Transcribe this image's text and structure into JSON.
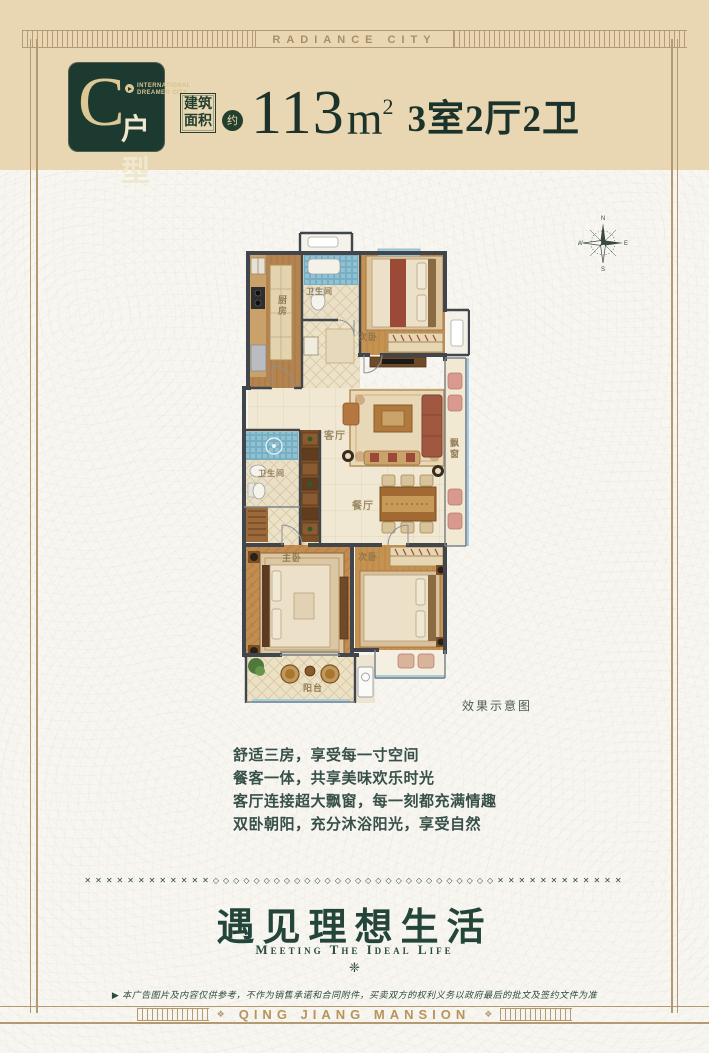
{
  "banner": {
    "top_text": "RADIANCE CITY",
    "bottom_text": "QING JIANG MANSION",
    "bottom_ornament": "❖"
  },
  "header": {
    "logo": {
      "letter": "C",
      "org_line1": "INTERNATIONAL",
      "org_line2": "DREAMER CITY",
      "type_label": "户型"
    },
    "area_box_line1": "建筑",
    "area_box_line2": "面积",
    "approx": "约",
    "area_value": "113",
    "area_unit": "m",
    "area_exponent": "2",
    "layout_spec": "3室2厅2卫"
  },
  "floorplan": {
    "caption": "效果示意图",
    "compass": {
      "n": "N",
      "e": "E",
      "s": "S",
      "w": "W"
    },
    "rooms": [
      {
        "label": "厨房"
      },
      {
        "label": "卫生间"
      },
      {
        "label": "次卧"
      },
      {
        "label": "客厅"
      },
      {
        "label": "餐厅"
      },
      {
        "label": "飘窗"
      },
      {
        "label": "卫生间"
      },
      {
        "label": "主卧"
      },
      {
        "label": "次卧"
      },
      {
        "label": "阳台"
      }
    ]
  },
  "features": {
    "lines": [
      "舒适三房，享受每一寸空间",
      "餐客一体，共享美味欢乐时光",
      "客厅连接超大飘窗，每一刻都充满情趣",
      "双卧朝阳，充分沐浴阳光，享受自然"
    ]
  },
  "slogan": {
    "divider": "✕✕✕✕✕✕✕✕✕✕✕✕◇◇◇◇◇◇◇◇◇◇◇◇◇◇◇◇◇◇◇◇◇◇◇◇◇◇◇◇✕✕✕✕✕✕✕✕✕✕✕✕",
    "title": "遇见理想生活",
    "subtitle": "Meeting The Ideal Life",
    "ornament": "❈",
    "disclaimer": "▶ 本广告图片及内容仅供参考，不作为销售承诺和合同附件，买卖双方的权利义务以政府最后的批文及签约文件为准"
  },
  "colors": {
    "header_bg": "#e9d7b3",
    "brand_green": "#1d3a31",
    "frame_gold": "#b49a72",
    "text_green": "#375049",
    "accent_gold": "#b8935a"
  }
}
